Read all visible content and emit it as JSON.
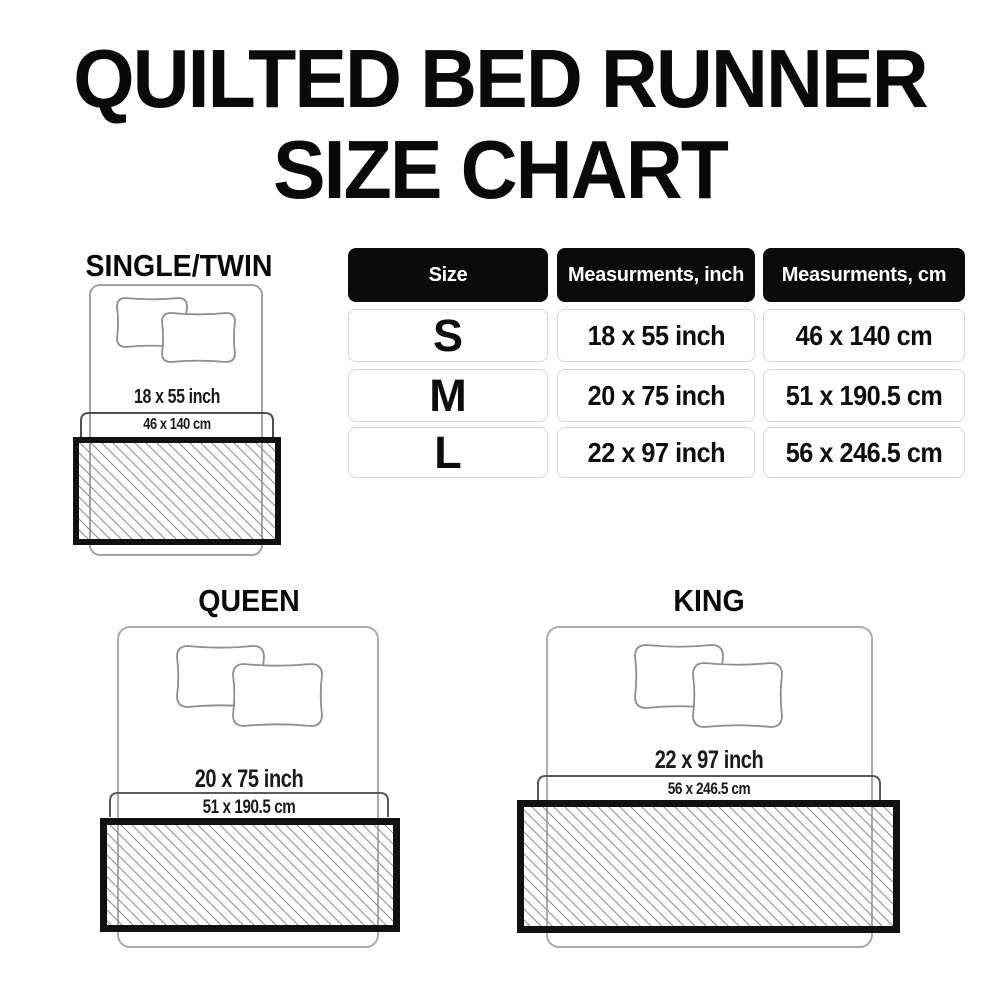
{
  "title": {
    "line1": "QUILTED BED RUNNER",
    "line2": "SIZE CHART"
  },
  "chart_data": {
    "type": "table",
    "title": "QUILTED BED RUNNER SIZE CHART",
    "columns": [
      "Size",
      "Measurments, inch",
      "Measurments, cm"
    ],
    "rows": [
      [
        "S",
        "18 x 55 inch",
        "46 x 140 cm"
      ],
      [
        "M",
        "20 x 75 inch",
        "51 x 190.5 cm"
      ],
      [
        "L",
        "22 x 97 inch",
        "56 x 246.5 cm"
      ]
    ],
    "legend_position": "none",
    "grid": false
  },
  "diagrams": [
    {
      "name": "SINGLE/TWIN",
      "inch": "18 x 55 inch",
      "cm": "46 x 140 cm"
    },
    {
      "name": "QUEEN",
      "inch": "20 x 75 inch",
      "cm": "51 x 190.5 cm"
    },
    {
      "name": "KING",
      "inch": "22 x 97 inch",
      "cm": "56 x 246.5 cm"
    }
  ],
  "colors": {
    "background": "#ffffff",
    "text": "#0a0a0a",
    "header_bg": "#0b0b0b",
    "header_text": "#ffffff",
    "cell_border": "#d6d6d6",
    "bed_outline": "#a3a3a3",
    "pillow_outline": "#8e8e8e",
    "bracket": "#4f4f4f",
    "hatch_line": "#909090",
    "runner_border": "#111111"
  }
}
